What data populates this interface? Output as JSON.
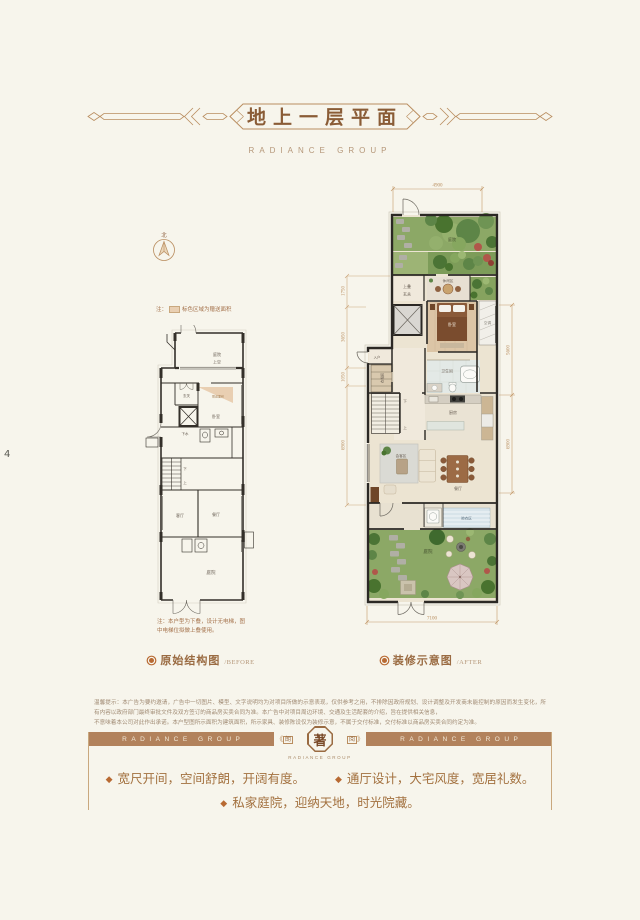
{
  "page": {
    "number": "4"
  },
  "header": {
    "title": "地上一层平面",
    "brand": "RADIANCE GROUP"
  },
  "compass": {
    "north": "北"
  },
  "legend": {
    "prefix": "注：",
    "text": "标色区域为赠送面积"
  },
  "before": {
    "caption": "原始结构图",
    "caption_en": "/BEFORE",
    "note1": "注：本户型为下叠，设计无电梯，图",
    "note2": "中电梯位拟做上叠使用。",
    "rooms": {
      "terrace1": "庭院",
      "terrace2": "上空",
      "foyer": "玄关",
      "bonus": "赠送面积",
      "bedroom": "卧室",
      "drain": "下水",
      "up": "上",
      "down": "下",
      "living": "客厅",
      "dining": "餐厅",
      "courtyard": "庭院"
    }
  },
  "after": {
    "caption": "装修示意图",
    "caption_en": "/AFTER",
    "rooms": {
      "garden_top": "庭院",
      "upper1": "上叠",
      "upper2": "玄关",
      "tea": "休闲区",
      "bedroom": "卧室",
      "ac": "空调",
      "entry": "入户",
      "closet": "衣帽间",
      "bath": "卫生间",
      "down": "下",
      "up": "上",
      "kitchen": "厨房",
      "living": "会客区",
      "dining": "餐厅",
      "laundry": "晾衣区",
      "garden_bottom": "庭院"
    },
    "dims": {
      "top": "4900",
      "bottom": "7100",
      "left1": "1750",
      "left2": "3650",
      "left3": "1050",
      "left4": "6900",
      "right1": "5600",
      "right2": "6900"
    }
  },
  "disclaimer": {
    "line1": "温馨提示：本广告为要约邀请，广告中一切图片、模型、文字说明均为对项目所做的示意表现，仅供参考之用，不排除因政府规划、设计调整及开发商未能控制的原因而发生变化，所有内容以政府部门最终审批文件及双方签订的商品房买卖合同为准。本广告中对项目周边环境、交通及生活配套的介绍，旨在提供相关信息，",
    "line2": "不意味着本公司对此作出承诺。本户型图所示面积为建筑面积，所示家具、装修陈设仅为装修示意，不属于交付标准，交付标准以商品房买卖合同约定为准。"
  },
  "banner": {
    "brand": "RADIANCE GROUP",
    "open": "《",
    "close": "》",
    "left_char": "朗",
    "center_char": "著",
    "right_char": "阅",
    "sub": "RADIANCE GROUP"
  },
  "points": {
    "bullet": "◆",
    "p1": "宽尺开间，空间舒朗，开阔有度。",
    "p2": "通厅设计，大宅风度，宽居礼数。",
    "p3": "私家庭院，迎纳天地，时光院藏。"
  },
  "colors": {
    "accent_brown": "#9a6b42",
    "banner_brown": "#b2825c",
    "bonus_tan": "#e9cfb2",
    "lawn_green": "#8ca866",
    "dim_line": "#c49a6a",
    "background": "#f7f5ec"
  }
}
